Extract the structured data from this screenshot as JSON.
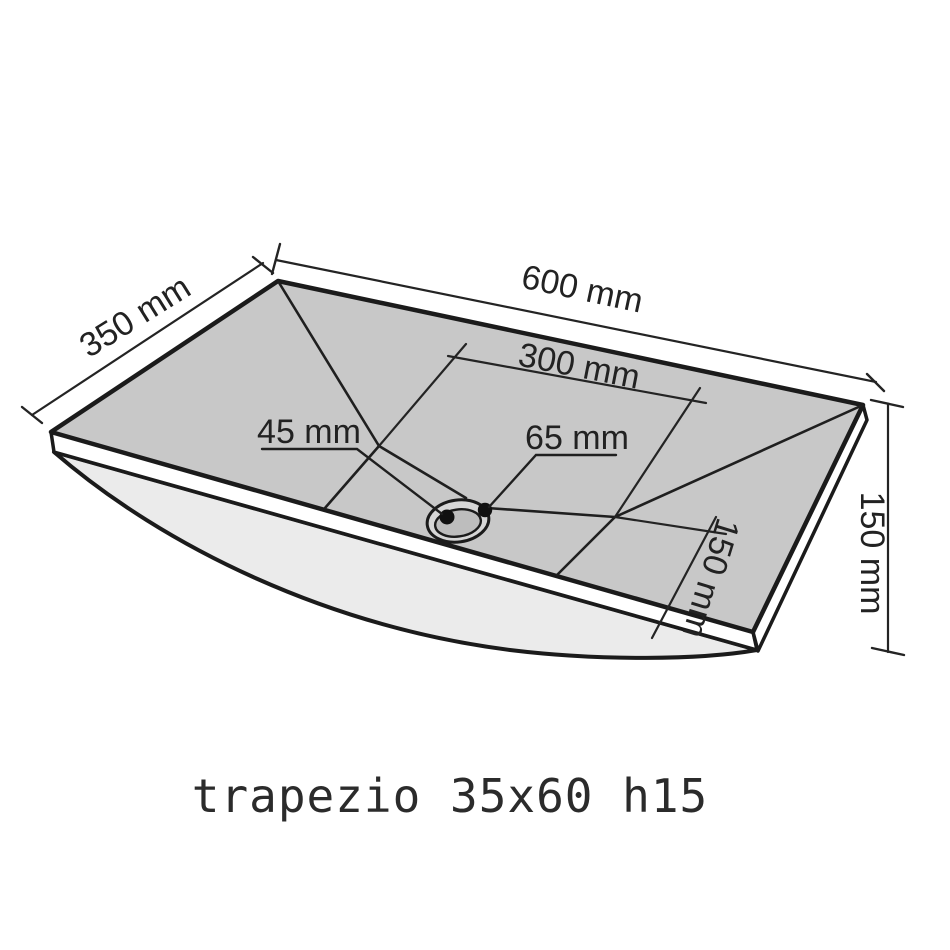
{
  "drawing": {
    "caption": "trapezio 35x60 h15",
    "labels": {
      "depth_left": "350 mm",
      "width_top": "600 mm",
      "half_width": "300 mm",
      "drain_hole": "45 mm",
      "drain_flange": "65 mm",
      "drain_offset_front": "150 mm",
      "height_right": "150 mm"
    },
    "colors": {
      "background": "#ffffff",
      "top_surface": "#c8c8c8",
      "underside": "#ebebeb",
      "rim_edge": "#ffffff",
      "line": "#1b1b1b",
      "drain_ring": "#d6d6d6",
      "drain_inner": "#bdbdbd"
    }
  }
}
